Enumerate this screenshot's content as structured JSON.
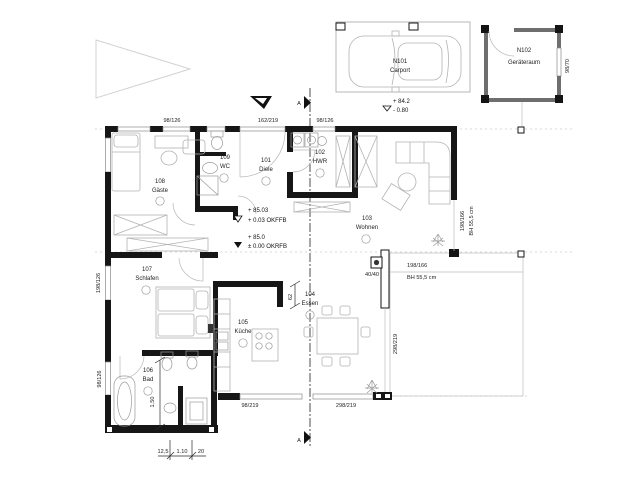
{
  "rooms": [
    {
      "number": "108",
      "name": "Gäste"
    },
    {
      "number": "109",
      "name": "WC"
    },
    {
      "number": "101",
      "name": "Diele"
    },
    {
      "number": "102",
      "name": "HWR"
    },
    {
      "number": "103",
      "name": "Wohnen"
    },
    {
      "number": "107",
      "name": "Schlafen"
    },
    {
      "number": "106",
      "name": "Bad"
    },
    {
      "number": "105",
      "name": "Küche"
    },
    {
      "number": "104",
      "name": "Essen"
    },
    {
      "number": "N101",
      "name": "Carport"
    },
    {
      "number": "N102",
      "name": "Geräteraum"
    }
  ],
  "elevations": {
    "carport_level": "+ 84.2",
    "carport_depth": "- 0.80",
    "ffb_level": "+ 85.03",
    "ffb_note": "+ 0.03 OKFFB",
    "rfb_level": "+ 85.0",
    "rfb_note": "± 0.00 OKRFB"
  },
  "dimensions": {
    "top_window_1": "98/126",
    "top_door": "162/219",
    "top_window_2": "98/126",
    "left_window_1": "198/126",
    "left_window_2": "98/126",
    "wohnen_side_window": "198/166",
    "wohnen_side_sill": "BH 55,5 cm",
    "terrace_window": "198/166",
    "terrace_sill": "BH 55,5 cm",
    "column": "40/40",
    "essen_window_v": "298/219",
    "bottom_window_1": "98/219",
    "bottom_window_2": "298/219",
    "kitchen_pass": "62",
    "bath_clear": "1.50",
    "chain_1": "12,5",
    "chain_2": "1.10",
    "chain_3": "20",
    "shed_window": "98/70"
  },
  "section": {
    "label_top": "A",
    "label_bottom": "A"
  }
}
